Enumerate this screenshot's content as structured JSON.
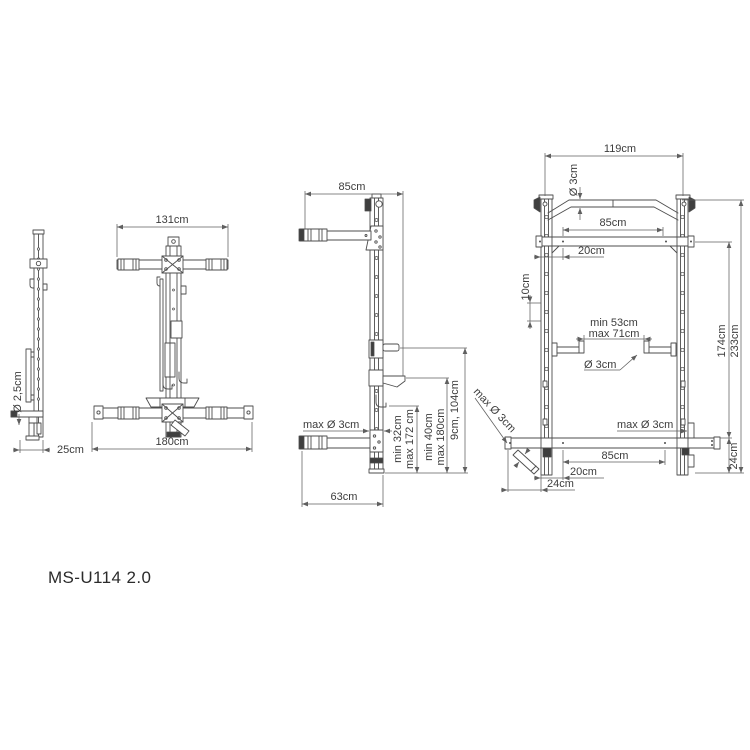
{
  "title": "MS-U114 2.0",
  "views": {
    "side_folded": {
      "label_diameter": "Ø 2,5cm",
      "label_depth": "25cm"
    },
    "front_folded": {
      "label_top_width": "131cm",
      "label_base_width": "180cm"
    },
    "side_open": {
      "label_top_depth": "85cm",
      "label_max_bar": "max Ø 3cm",
      "label_hook_min": "min 32cm",
      "label_hook_max": "max 172 cm",
      "label_shelf_min": "min 40cm",
      "label_shelf_max": "max 180cm",
      "label_peg_range": "9cm, 104cm",
      "label_base_depth": "63cm"
    },
    "front_open": {
      "label_total_width": "119cm",
      "label_bar_dia": "Ø 3cm",
      "label_top_span": "85cm",
      "label_top_offset": "20cm",
      "label_hole_spacing": "10cm",
      "label_gap_min": "min 53cm",
      "label_gap_max": "max 71cm",
      "label_cup_dia": "Ø 3cm",
      "label_mount_height": "174cm",
      "label_total_height": "233cm",
      "label_diag_peg": "max Ø 3cm",
      "label_side_peg": "max Ø 3cm",
      "label_bottom_span": "85cm",
      "label_bottom_offset": "20cm",
      "label_bottom_inset": "24cm",
      "label_base_height": "24cm"
    }
  }
}
